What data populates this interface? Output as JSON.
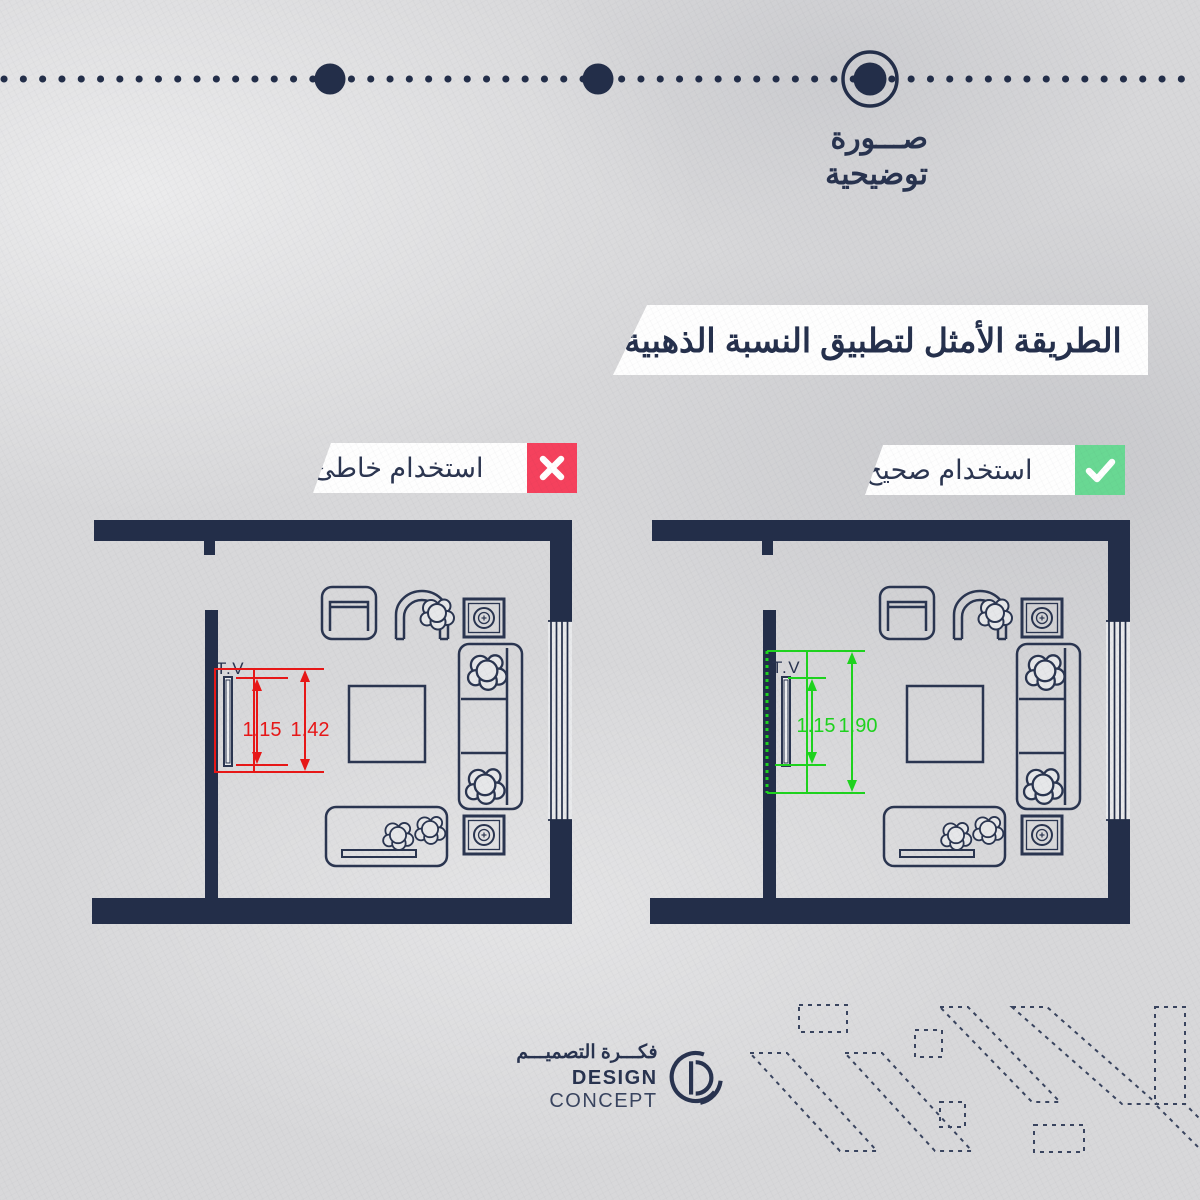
{
  "palette": {
    "background": "#d8d8da",
    "navy": "#232e49",
    "banner_bg": "#ffffff",
    "wrong_accent": "#e81717",
    "correct_accent": "#1ed31e",
    "wrong_badge": "#f5415d",
    "correct_badge": "#69d893"
  },
  "timeline": {
    "caption": {
      "line1": "صـــورة",
      "line2": "توضيحية"
    }
  },
  "title": {
    "text": "الطريقة الأمثل لتطبيق النسبة الذهبية:"
  },
  "labels": {
    "wrong": {
      "text": "استخدام خاطئ"
    },
    "correct": {
      "text": "استخدام صحيح"
    }
  },
  "plans": {
    "wrong": {
      "tv_label": "T.V",
      "dim_tv": "1.15",
      "dim_wall": "1.42"
    },
    "correct": {
      "tv_label": "T.V",
      "dim_tv": "1.15",
      "dim_wall": "1.90"
    }
  },
  "footer": {
    "logo_arabic": "فكـــرة التصميـــم",
    "logo_english_bold": "DESIGN",
    "logo_english_light": "CONCEPT"
  }
}
